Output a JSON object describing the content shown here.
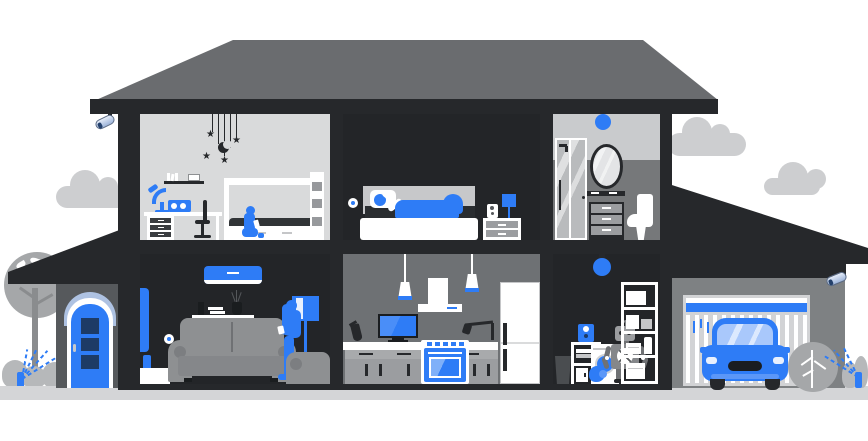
{
  "scene": {
    "description": "Flat-style cutaway illustration of a two-story smart home with attached garage, outdoor trees, sprinklers and security cameras. No visible text in the image.",
    "background": "#FFFFFF"
  },
  "palette": {
    "accent_blue": "#2E7CF6",
    "mid_blue": "#5B97F8",
    "pale_blue": "#A9C8FB",
    "steel_blue": "#AEC2E2",
    "navy": "#1D3B66",
    "frame_dark": "#26282B",
    "frame_darker": "#1A1D20",
    "roof_gray": "#6A6C6F",
    "wall_gray": "#76787A",
    "wall_gray_light": "#C9CBCD",
    "kitchen_gray": "#6E7174",
    "room_light": "#D9DADB",
    "room_dark": "#232528",
    "furniture_gray": "#8E9092",
    "cabinet_gray": "#9B9DA0",
    "garage_wall": "#7E8183",
    "garage_door": "#D2D3D5",
    "ground": "#D4D5D7",
    "cloud": "#CDCED0",
    "tree": "#A5A7A9",
    "trunk": "#8A8C8E",
    "bush": "#B6B8BA",
    "white": "#FFFFFF"
  },
  "labels": {
    "house": "smart home cutaway",
    "kids_room": "kids room",
    "bedroom": "bedroom",
    "bathroom": "bathroom",
    "living_room": "living room",
    "kitchen": "kitchen",
    "laundry_room": "laundry room",
    "garage": "garage",
    "front_porch": "front porch with blue door"
  },
  "inventory": {
    "outdoor": [
      "cloud-left",
      "cloud-right-large",
      "cloud-right-small",
      "tree",
      "bushes",
      "sprinkler-left",
      "sprinkler-right",
      "shrub-right",
      "ground"
    ],
    "security": [
      "cctv-camera-left-eave",
      "cctv-camera-garage"
    ],
    "kids_room": [
      "stars-moon-mobile",
      "wall-shelf-books",
      "desk",
      "desk-lamp-blue",
      "radio-blue",
      "office-chair",
      "bunk-bed",
      "child-with-phone"
    ],
    "bedroom": [
      "smart-wall-device",
      "bed",
      "person-sleeping-blue-blanket",
      "nightstand",
      "speaker",
      "table-lamp-blue"
    ],
    "bathroom": [
      "smart-ceiling-light-blue",
      "shower-cabin",
      "oval-mirror",
      "vanity-shelf",
      "vanity-cabinet",
      "toilet"
    ],
    "living_room": [
      "air-conditioner-blue",
      "wall-shelf-decor",
      "smart-wall-device",
      "tv-side-view",
      "media-console",
      "sofa",
      "floor-lamp-blue",
      "armchair",
      "woman-with-phone"
    ],
    "kitchen": [
      "pendant-lamp",
      "pendant-lamp",
      "range-hood",
      "countertop-tv-blue",
      "kettle",
      "faucet",
      "counter",
      "cabinets",
      "oven-blue",
      "refrigerator"
    ],
    "laundry_room": [
      "smart-bulb-blue",
      "trash-bin",
      "side-table",
      "speaker-blue",
      "washing-machine",
      "home-robot",
      "storage-shelf"
    ],
    "garage": [
      "garage-door",
      "car-blue",
      "cctv-camera-garage"
    ]
  }
}
